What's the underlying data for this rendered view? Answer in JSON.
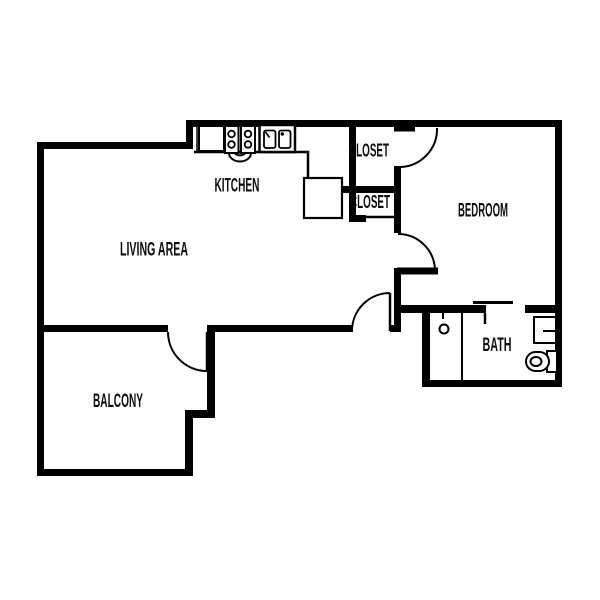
{
  "plan": {
    "type": "apartment-floor-plan",
    "colors": {
      "wall": "#000000",
      "background": "#ffffff",
      "text": "#0d0d0d"
    },
    "rooms": {
      "kitchen": {
        "label": "KITCHEN"
      },
      "closet_upper": {
        "label": "CLOSET"
      },
      "closet_lower": {
        "label": "CLOSET"
      },
      "bedroom": {
        "label": "BEDROOM"
      },
      "living_area": {
        "label": "LIVING AREA"
      },
      "bath": {
        "label": "BATH"
      },
      "balcony": {
        "label": "BALCONY"
      }
    },
    "fixtures": [
      "refrigerator",
      "stove-four-burners",
      "oven-door",
      "double-basin-sink",
      "kitchen-peninsula-cabinet",
      "shower-stall",
      "shower-drain",
      "bathroom-vanity",
      "toilet"
    ],
    "doors": [
      "closet-swing-door-to-bedroom",
      "bedroom-entry-swing-door",
      "hallway-swing-door-to-living-area",
      "balcony-swing-door",
      "lower-closet-sliding-door",
      "bath-sliding-door"
    ]
  }
}
